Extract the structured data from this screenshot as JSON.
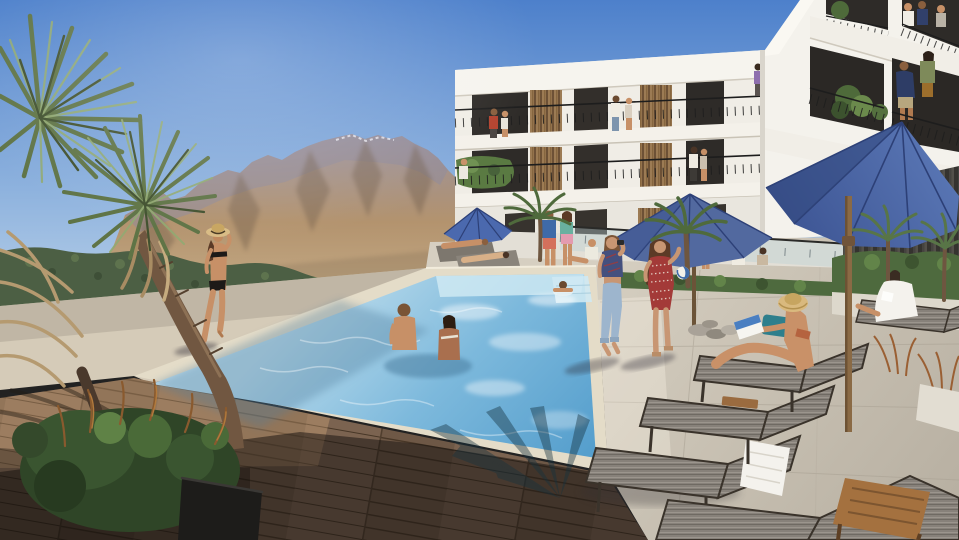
{
  "meta": {
    "title": "Palm-desert apartment complex pool courtyard — photorealistic architectural rendering",
    "type": "architectural-rendering",
    "time_of_day": "sunny midday",
    "no_visible_text": true
  },
  "palette": {
    "sky_top": "#4d80cb",
    "sky_mid": "#8fb3de",
    "sky_horizon": "#c2d8ec",
    "mountain_ridge": "#8f8a9b",
    "mountain_sunlit": "#bd9d77",
    "mountain_shadow": "#6f5c49",
    "hedge_green": "#4c5f44",
    "palm_green": "#5f7446",
    "palm_highlight": "#92aa72",
    "dried_frond": "#b59a70",
    "building_white": "#f0ede6",
    "opening_dark": "#2e2b28",
    "wood_slats": "#95744e",
    "railing_black": "#1d1d1d",
    "umbrella_blue": "#52699f",
    "umbrella_rib": "#2d4077",
    "umbrella_pole_wood": "#8a6a45",
    "pool_far": "#bcdcec",
    "pool_mid": "#7db9dc",
    "pool_deep": "#5fa6d2",
    "coping_stone": "#e4dcc8",
    "walkway": "#d5cbb8",
    "wood_deck": "#6e5846",
    "concrete_deck": "#c9c2b4",
    "lounger_fabric": "#87817a",
    "lounger_frame": "#3a332b",
    "teak_table": "#a4713f",
    "towel_white": "#f4f2ed",
    "skin_tan": "#c79067",
    "skin_deep": "#a96f4e"
  },
  "scene": {
    "sky": "clear blue gradient sky",
    "mountains": "hazy desert mountain range (San Jacinto style) with bluish rocky ridge and tan sunlit slopes",
    "background": "low treeline of shrubs and small palms at the mountain base",
    "building": {
      "description": "modern white stucco L-shaped apartment block, 3 floors, open walkways, vertical wood-slat privacy screens, black metal railings, balconies with potted palms",
      "floors": 3,
      "wings": 2
    },
    "pool": "large rectangular pool, aqua water with sparkle caustics, stone coping, shallow shelf at far right corner",
    "decks": [
      "light travertine walkway along the hedge",
      "dark wood plank deck in the left foreground (partly in shade)",
      "large-format concrete tile deck on the right"
    ],
    "umbrellas": {
      "count": 4,
      "color_name": "cobalt blue",
      "note": "one small at far patio, one mid-size over loungers, one very large over the right deck"
    },
    "loungers": {
      "count": 10,
      "style": "gray mesh chaise lounges with dark frames and teak side tables"
    },
    "vegetation": [
      "two spiky yucca palm crowns foreground left",
      "dried tan fronds and curved palm trunk",
      "dark green shrub planter in black box",
      "dense hedge along pool far side",
      "mid-ground fan palms",
      "bronze ornamental grasses by right fence"
    ],
    "props": [
      "white towel on lounger",
      "straw hats",
      "magazine",
      "blue-white beach ball",
      "decorative stone pile",
      "teak tray"
    ]
  },
  "people": [
    {
      "name": "person-bikini-woman",
      "description": "woman in black bikini and straw sun hat walking along far pool walkway"
    },
    {
      "name": "person-swimming-man",
      "description": "man standing waist-deep in pool, facing companion"
    },
    {
      "name": "person-swimming-woman",
      "description": "woman with dark skin and black ponytail in pool beside him"
    },
    {
      "name": "person-swimmer-far",
      "description": "swimmer at the far shallow end"
    },
    {
      "name": "person-walker-blue",
      "description": "woman in navy plaid crop top and light capri jeans walking on right deck, arm raised with camera"
    },
    {
      "name": "person-walker-red",
      "description": "woman in red patterned mini dress with long brown hair walking beside her"
    },
    {
      "name": "person-reading-woman",
      "description": "woman in straw hat and bikini reading a magazine on a chaise lounge"
    },
    {
      "name": "person-robe-woman",
      "description": "woman in white robe relaxing on far-right lounger"
    },
    {
      "name": "person-balcony-man",
      "description": "man in navy floral shirt on second-floor balcony"
    },
    {
      "name": "person-balcony-woman",
      "description": "woman in sage top talking with him"
    },
    {
      "name": "person-top-balcony-group",
      "description": "three residents on the top-right balcony"
    },
    {
      "name": "person-floor3-couple-left",
      "description": "couple (red shirt / white top) at left end of third-floor walkway"
    },
    {
      "name": "person-floor3-couple-mid",
      "description": "two people walking the third-floor walkway"
    },
    {
      "name": "person-floor2-couple",
      "description": "couple strolling the second-floor walkway"
    },
    {
      "name": "person-floor3-purple",
      "description": "woman in purple near the corner walkway"
    },
    {
      "name": "person-balcony2-left",
      "description": "man in white by the planted second-floor balcony"
    },
    {
      "name": "person-terrace-girl",
      "description": "girl in white top and denim shorts at the terrace glass railing"
    },
    {
      "name": "person-terrace-seated",
      "description": "two residents seated on the ground-floor terrace"
    },
    {
      "name": "person-patio-couple",
      "description": "standing couple on pool patio: man in blue tee and coral shorts, woman in teal top and pink skirt"
    },
    {
      "name": "person-patio-loungers",
      "description": "sunbathers lying on the far patio loungers"
    }
  ]
}
